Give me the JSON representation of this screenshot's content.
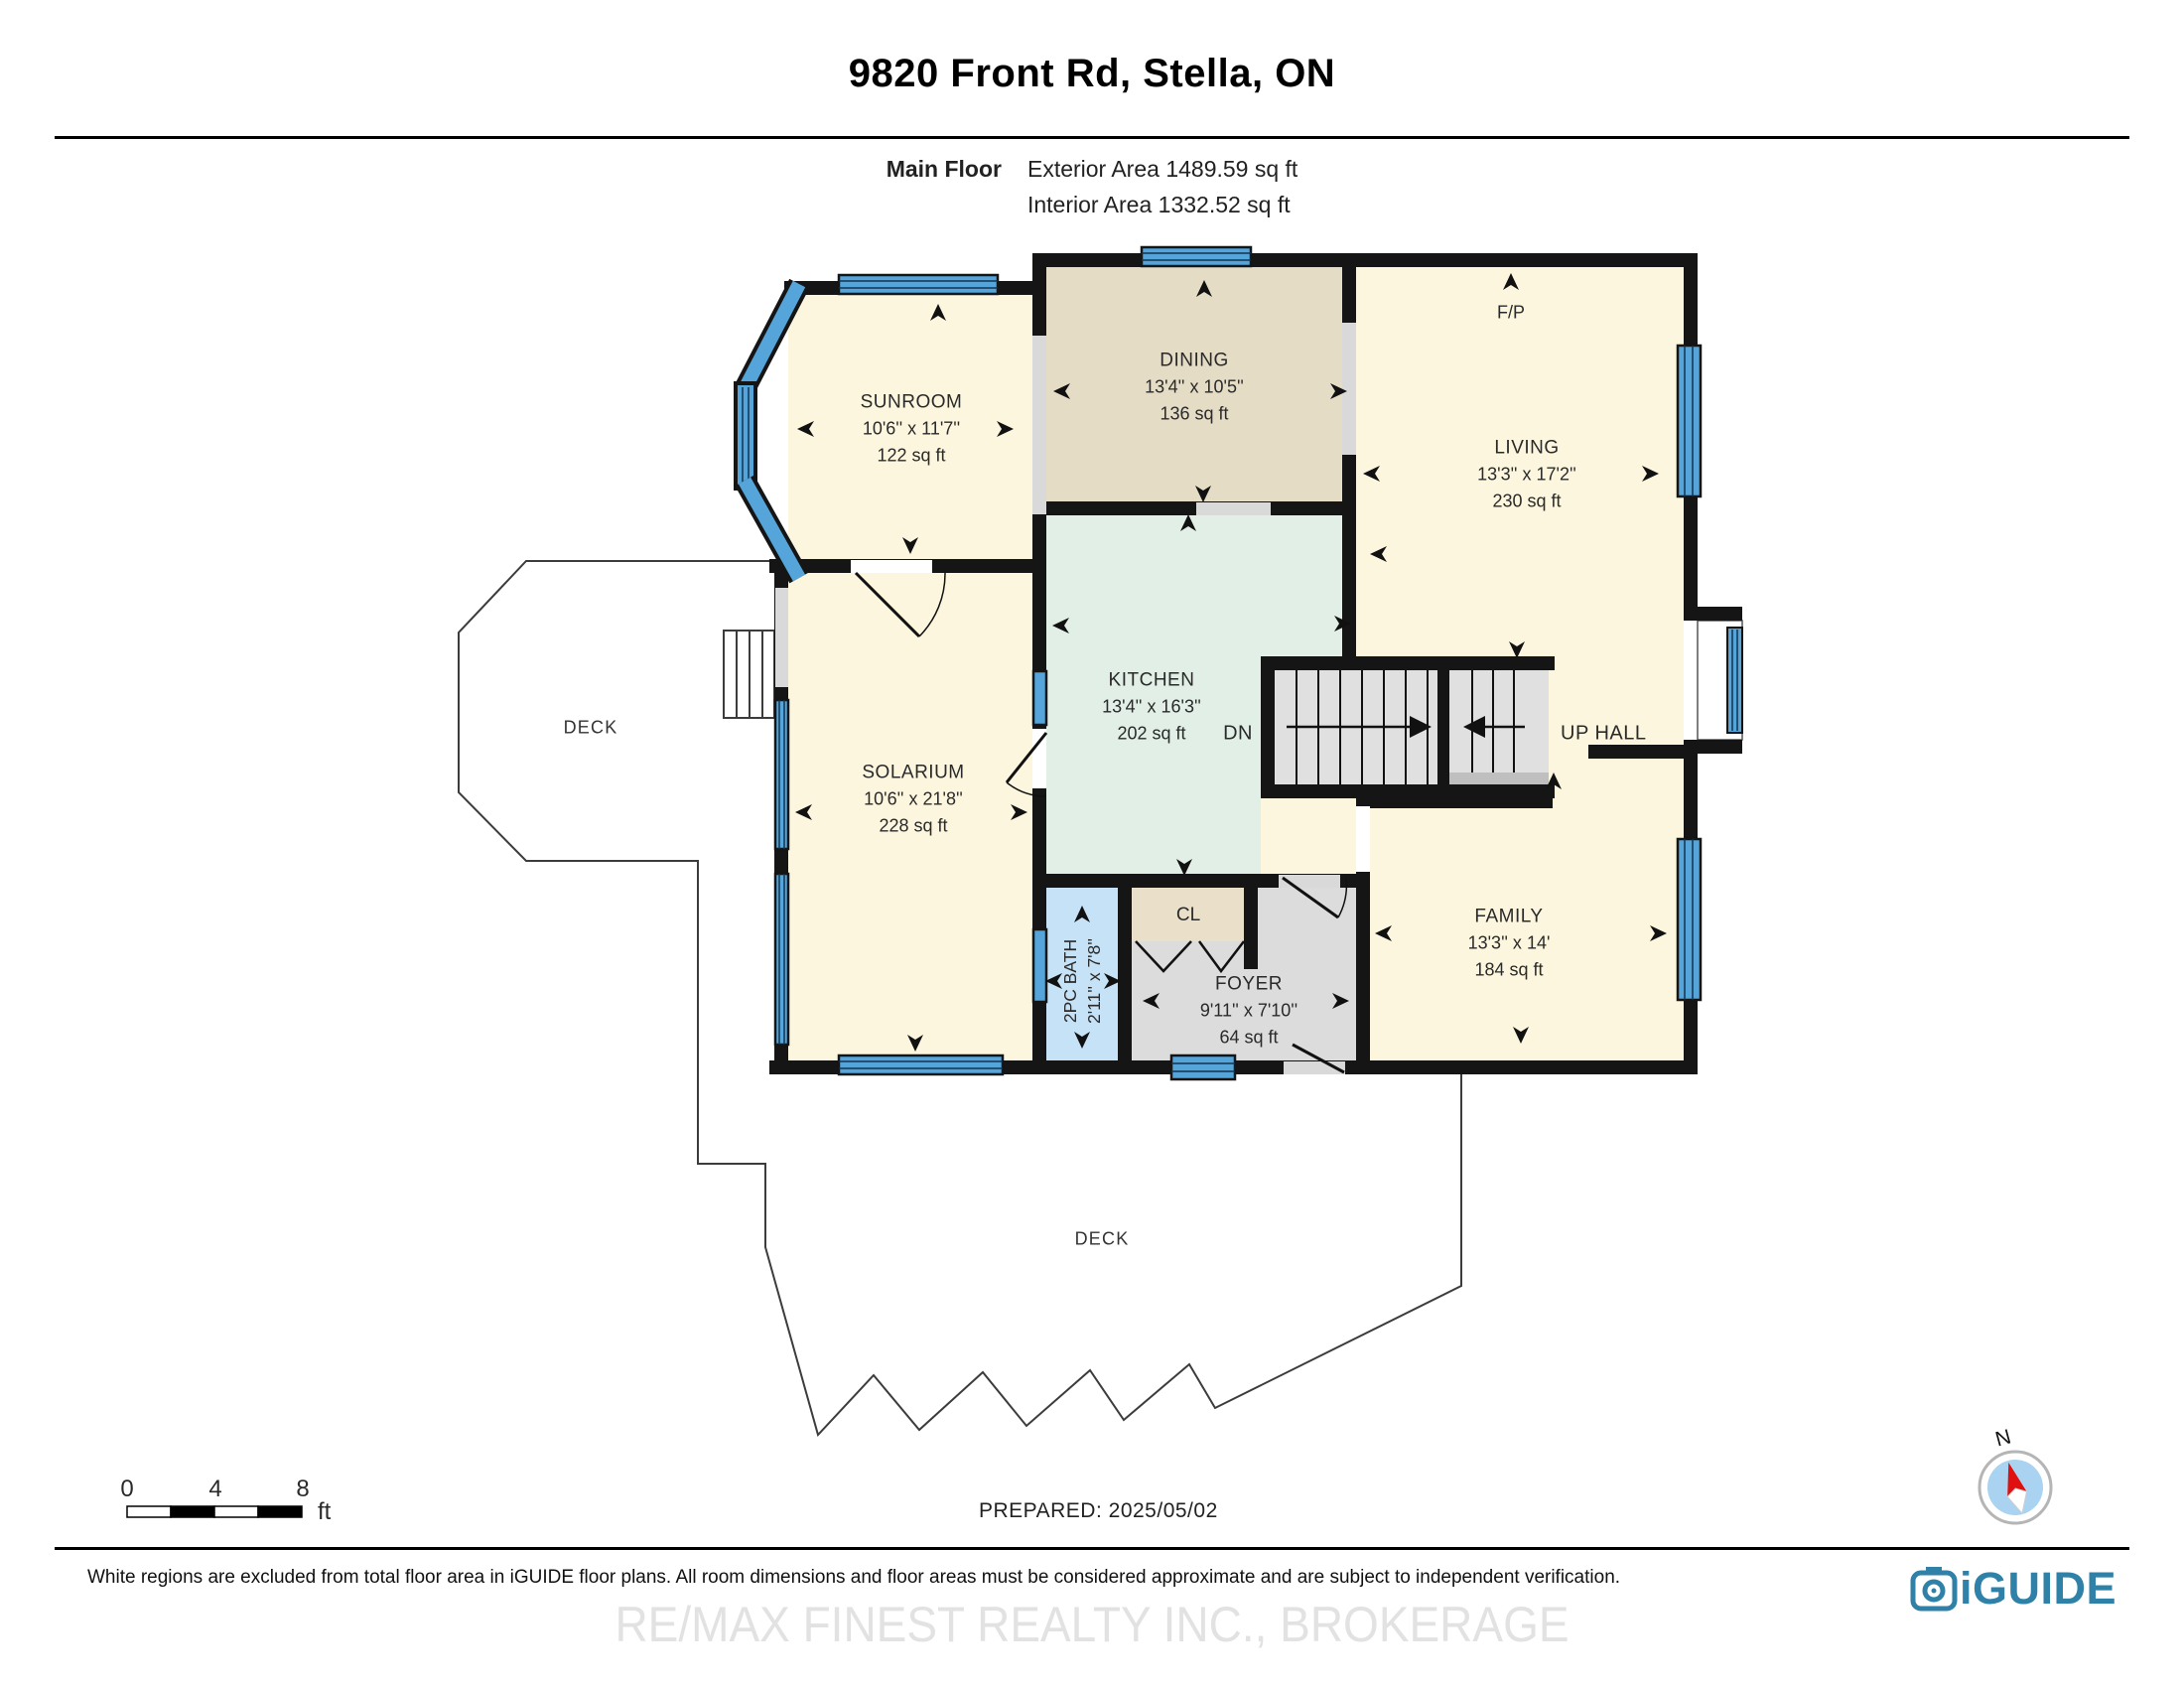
{
  "header": {
    "title": "9820 Front Rd, Stella, ON",
    "floor_label": "Main Floor",
    "exterior_area": "Exterior Area 1489.59 sq ft",
    "interior_area": "Interior Area 1332.52 sq ft"
  },
  "rooms": {
    "sunroom": {
      "name": "SUNROOM",
      "dims": "10'6'' x 11'7''",
      "area": "122 sq ft"
    },
    "dining": {
      "name": "DINING",
      "dims": "13'4'' x 10'5''",
      "area": "136 sq ft"
    },
    "living": {
      "name": "LIVING",
      "dims": "13'3'' x 17'2''",
      "area": "230 sq ft"
    },
    "kitchen": {
      "name": "KITCHEN",
      "dims": "13'4'' x 16'3''",
      "area": "202 sq ft"
    },
    "solarium": {
      "name": "SOLARIUM",
      "dims": "10'6'' x 21'8''",
      "area": "228 sq ft"
    },
    "family": {
      "name": "FAMILY",
      "dims": "13'3'' x 14'",
      "area": "184 sq ft"
    },
    "foyer": {
      "name": "FOYER",
      "dims": "9'11'' x 7'10''",
      "area": "64 sq ft"
    },
    "bath": {
      "name": "2PC BATH",
      "dims": "2'11'' x 7'8''"
    },
    "closet": {
      "name": "CL"
    },
    "deck_left": {
      "name": "DECK"
    },
    "deck_bottom": {
      "name": "DECK"
    }
  },
  "plan_labels": {
    "fireplace": "F/P",
    "stairs_down": "DN",
    "up_hall": "UP HALL",
    "compass_north": "N"
  },
  "scale_bar": {
    "tick0": "0",
    "tick4": "4",
    "tick8": "8",
    "unit": "ft"
  },
  "footer": {
    "prepared": "PREPARED: 2025/05/02",
    "disclaimer": "White regions are excluded from total floor area in iGUIDE floor plans. All room dimensions and floor areas must be considered approximate and are subject to independent verification.",
    "watermark": "RE/MAX FINEST REALTY INC., BROKERAGE",
    "logo_text": "iGUIDE"
  },
  "colors": {
    "wall": "#151515",
    "window_blue": "#55A5DA",
    "room_cream": "#FCF6DF",
    "room_tan": "#E5DCC6",
    "room_mint": "#E1EFE6",
    "room_gray": "#DCDCDC",
    "room_bath_blue": "#C6E2F7",
    "closet_tan": "#EADFC8",
    "opening_gray": "#D9D9D9",
    "logo_blue": "#2F81A8",
    "compass_fill": "#A9D3F0",
    "needle_red": "#E01010"
  }
}
